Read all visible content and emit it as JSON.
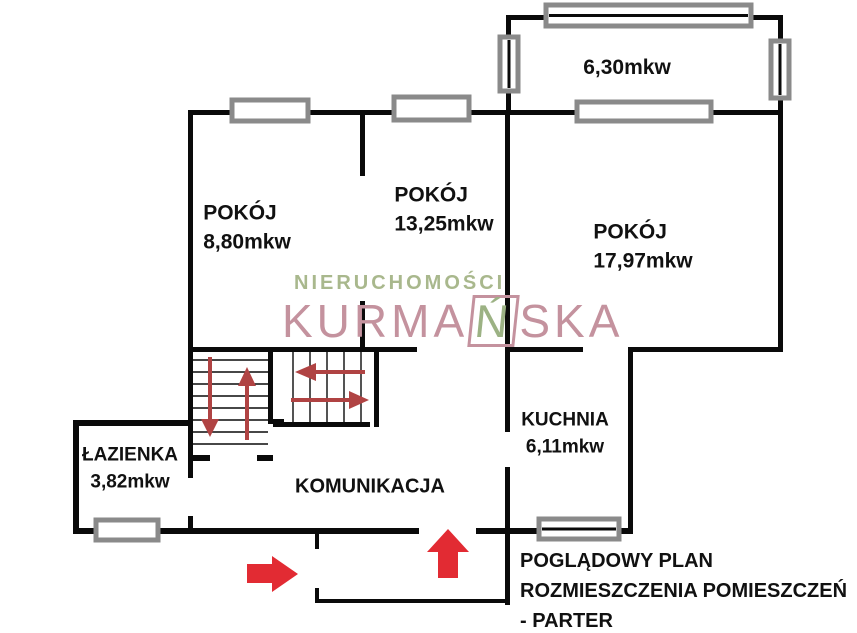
{
  "rooms": [
    {
      "id": "pokoj-1",
      "name": "POKÓJ",
      "area": "8,80mkw"
    },
    {
      "id": "pokoj-2",
      "name": "POKÓJ",
      "area": "13,25mkw"
    },
    {
      "id": "pokoj-3",
      "name": "POKÓJ",
      "area": "17,97mkw"
    },
    {
      "id": "balkon",
      "name": "",
      "area": "6,30mkw"
    },
    {
      "id": "kuchnia",
      "name": "KUCHNIA",
      "area": "6,11mkw"
    },
    {
      "id": "lazienka",
      "name": "ŁAZIENKA",
      "area": "3,82mkw"
    },
    {
      "id": "komunikacja",
      "name": "KOMUNIKACJA",
      "area": ""
    }
  ],
  "caption": {
    "line1": "POGLĄDOWY PLAN",
    "line2": "ROZMIESZCZENIA POMIESZCZEŃ",
    "line3": "- PARTER"
  },
  "watermark": {
    "line1": "NIERUCHOMOŚCI",
    "line2_prefix": "KURMA",
    "line2_n": "Ń",
    "line2_suffix": "SKA"
  },
  "colors": {
    "wall_black": "#0a0a0a",
    "window_gray": "#8a8a8a",
    "entry_arrow_red": "#e22b33",
    "stair_arrow_red": "#b04343",
    "watermark_green": "#a9b88d",
    "watermark_pink": "#c4929e"
  },
  "floorplan": {
    "walls": [
      {
        "name": "top-wall",
        "x": 188,
        "y": 110,
        "w": 595,
        "h": 5
      },
      {
        "name": "left-wall",
        "x": 188,
        "y": 110,
        "w": 5,
        "h": 242
      },
      {
        "name": "right-wall",
        "x": 778,
        "y": 15,
        "w": 5,
        "h": 337
      },
      {
        "name": "balcony-left-wall",
        "x": 506,
        "y": 15,
        "w": 5,
        "h": 100
      },
      {
        "name": "balcony-top-wall",
        "x": 506,
        "y": 15,
        "w": 277,
        "h": 5
      },
      {
        "name": "room-divider-upper",
        "x": 360,
        "y": 110,
        "w": 5,
        "h": 66
      },
      {
        "name": "room-divider-lower",
        "x": 360,
        "y": 301,
        "w": 5,
        "h": 51
      },
      {
        "name": "mid-wall",
        "x": 505,
        "y": 110,
        "w": 5,
        "h": 322
      },
      {
        "name": "kitchen-left-wall",
        "x": 505,
        "y": 467,
        "w": 5,
        "h": 138
      },
      {
        "name": "corridor-top-wall",
        "x": 188,
        "y": 347,
        "w": 229,
        "h": 5
      },
      {
        "name": "kitchen-top-wall",
        "x": 505,
        "y": 347,
        "w": 78,
        "h": 5
      },
      {
        "name": "room3-bottom-wall",
        "x": 628,
        "y": 347,
        "w": 155,
        "h": 5
      },
      {
        "name": "kitchen-right-wall",
        "x": 628,
        "y": 347,
        "w": 5,
        "h": 187
      },
      {
        "name": "bottom-wall-left",
        "x": 73,
        "y": 528,
        "w": 346,
        "h": 6
      },
      {
        "name": "bottom-wall-mid",
        "x": 476,
        "y": 528,
        "w": 32,
        "h": 6
      },
      {
        "name": "kitchen-bottom-stub-left",
        "x": 508,
        "y": 528,
        "w": 34,
        "h": 6
      },
      {
        "name": "kitchen-bottom-stub-right",
        "x": 616,
        "y": 528,
        "w": 17,
        "h": 6
      },
      {
        "name": "bathroom-left-wall",
        "x": 73,
        "y": 420,
        "w": 6,
        "h": 114
      },
      {
        "name": "bathroom-top-wall",
        "x": 73,
        "y": 420,
        "w": 115,
        "h": 6
      },
      {
        "name": "bathroom-right-wall",
        "x": 188,
        "y": 352,
        "w": 5,
        "h": 126
      },
      {
        "name": "bathroom-door-stub",
        "x": 188,
        "y": 516,
        "w": 5,
        "h": 18
      },
      {
        "name": "stairs-mid-wall",
        "x": 268,
        "y": 347,
        "w": 5,
        "h": 76
      },
      {
        "name": "stairs-mid-lip",
        "x": 268,
        "y": 419,
        "w": 16,
        "h": 5
      },
      {
        "name": "stairs-left-bottom-a",
        "x": 188,
        "y": 455,
        "w": 22,
        "h": 6
      },
      {
        "name": "stairs-left-bottom-b",
        "x": 257,
        "y": 455,
        "w": 16,
        "h": 6
      },
      {
        "name": "stairs-right-bottom",
        "x": 273,
        "y": 422,
        "w": 97,
        "h": 5
      },
      {
        "name": "stairs-right-wall",
        "x": 374,
        "y": 352,
        "w": 5,
        "h": 75
      },
      {
        "name": "porch-left-upper",
        "x": 315,
        "y": 534,
        "w": 4,
        "h": 15
      },
      {
        "name": "porch-left-lower",
        "x": 315,
        "y": 588,
        "w": 4,
        "h": 15
      },
      {
        "name": "porch-bottom",
        "x": 315,
        "y": 599,
        "w": 193,
        "h": 4
      }
    ],
    "windows": [
      {
        "name": "window-room1-top",
        "x": 232,
        "y": 100,
        "w": 76,
        "h": 21,
        "innerline": false
      },
      {
        "name": "window-room2-top",
        "x": 394,
        "y": 97,
        "w": 75,
        "h": 23,
        "innerline": false
      },
      {
        "name": "window-balcony-top",
        "x": 546,
        "y": 5,
        "w": 205,
        "h": 21,
        "innerline": true
      },
      {
        "name": "window-balcony-left",
        "x": 500,
        "y": 37,
        "w": 18,
        "h": 54,
        "innerline": true
      },
      {
        "name": "window-balcony-right",
        "x": 771,
        "y": 41,
        "w": 18,
        "h": 57,
        "innerline": true
      },
      {
        "name": "window-balcony-bottom",
        "x": 577,
        "y": 102,
        "w": 134,
        "h": 19,
        "innerline": false
      },
      {
        "name": "window-bathroom",
        "x": 96,
        "y": 520,
        "w": 62,
        "h": 20,
        "innerline": false
      },
      {
        "name": "window-kitchen",
        "x": 539,
        "y": 519,
        "w": 80,
        "h": 20,
        "innerline": true
      }
    ],
    "stair_treads": {
      "left_block": {
        "orient": "h",
        "from": 193,
        "to": 268,
        "start": 360,
        "step": 12,
        "count": 8
      },
      "right_block": {
        "orient": "v",
        "from": 352,
        "to": 422,
        "start": 293,
        "step": 17,
        "count": 5
      }
    },
    "arrows": [
      {
        "name": "entry-arrow-right",
        "kind": "block",
        "color": "entry_arrow_red",
        "points": [
          [
            247,
            564
          ],
          [
            272,
            564
          ],
          [
            272,
            556
          ],
          [
            298,
            574
          ],
          [
            272,
            592
          ],
          [
            272,
            583
          ],
          [
            247,
            583
          ]
        ]
      },
      {
        "name": "entry-arrow-up",
        "kind": "block",
        "color": "entry_arrow_red",
        "points": [
          [
            438,
            578
          ],
          [
            438,
            552
          ],
          [
            427,
            552
          ],
          [
            448,
            529
          ],
          [
            469,
            552
          ],
          [
            458,
            552
          ],
          [
            458,
            578
          ]
        ]
      },
      {
        "name": "stair-arrow-down",
        "kind": "line",
        "color": "stair_arrow_red",
        "stem": [
          [
            210,
            357
          ],
          [
            210,
            426
          ]
        ],
        "head": [
          [
            201,
            419
          ],
          [
            219,
            419
          ],
          [
            210,
            437
          ]
        ]
      },
      {
        "name": "stair-arrow-up",
        "kind": "line",
        "color": "stair_arrow_red",
        "stem": [
          [
            247,
            440
          ],
          [
            247,
            372
          ]
        ],
        "head": [
          [
            238,
            386
          ],
          [
            256,
            386
          ],
          [
            247,
            367
          ]
        ]
      },
      {
        "name": "stair-arrow-left",
        "kind": "line",
        "color": "stair_arrow_red",
        "stem": [
          [
            365,
            372
          ],
          [
            305,
            372
          ]
        ],
        "head": [
          [
            316,
            363
          ],
          [
            316,
            381
          ],
          [
            295,
            372
          ]
        ]
      },
      {
        "name": "stair-arrow-right",
        "kind": "line",
        "color": "stair_arrow_red",
        "stem": [
          [
            291,
            400
          ],
          [
            350,
            400
          ]
        ],
        "head": [
          [
            349,
            391
          ],
          [
            349,
            409
          ],
          [
            369,
            400
          ]
        ]
      }
    ]
  }
}
